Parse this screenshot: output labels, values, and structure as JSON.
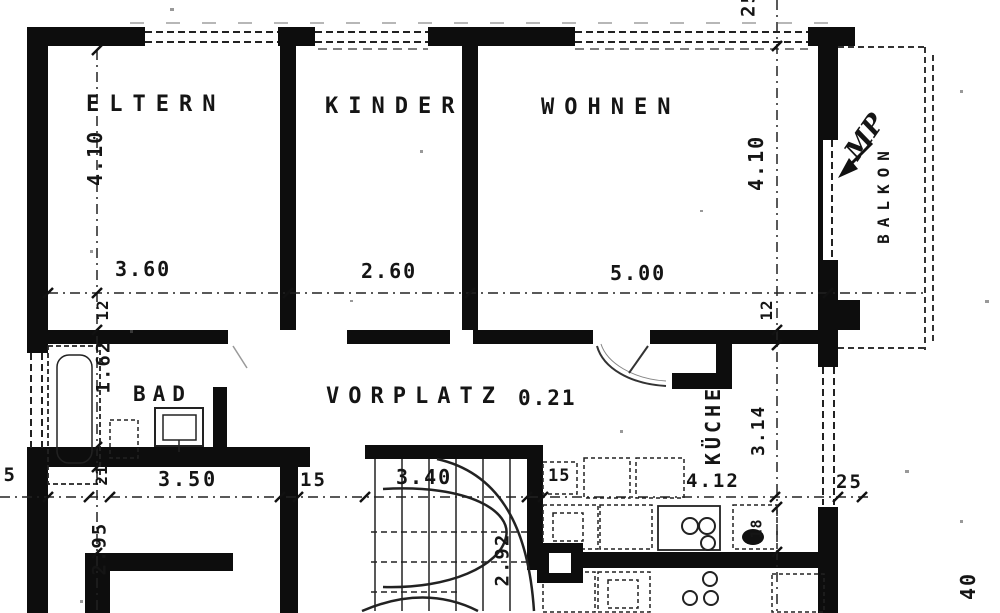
{
  "colors": {
    "ink": "#151515",
    "paper": "#ffffff"
  },
  "rooms": {
    "eltern": "ELTERN",
    "kinder": "KINDER",
    "wohnen": "WOHNEN",
    "bad": "BAD",
    "vorplatz": "VORPLATZ",
    "vorplatz_area": "0.21",
    "kueche": "KÜCHE",
    "balkon": "BALKON"
  },
  "dims": {
    "eltern_width": "3.60",
    "eltern_height": "4.10",
    "kinder_width": "2.60",
    "wohnen_width": "5.00",
    "wohnen_height": "4.10",
    "bad_height": "1.62",
    "wall_12_left": "12",
    "wall_12_right": "12",
    "wall_21": "21",
    "wall_15_right": "15",
    "wall_15_box": "15",
    "wall_25_left": "25",
    "wall_25_top": "25",
    "wall_25_right": "25",
    "wall_18": "18",
    "room_bl_width": "3.50",
    "room_bl_height": "2.95",
    "stair_width": "3.40",
    "stair_height": "2.92",
    "kueche_width": "4.12",
    "kueche_height": "3.14",
    "edge_40": "40"
  },
  "annotations": {
    "handwritten": "MP"
  }
}
